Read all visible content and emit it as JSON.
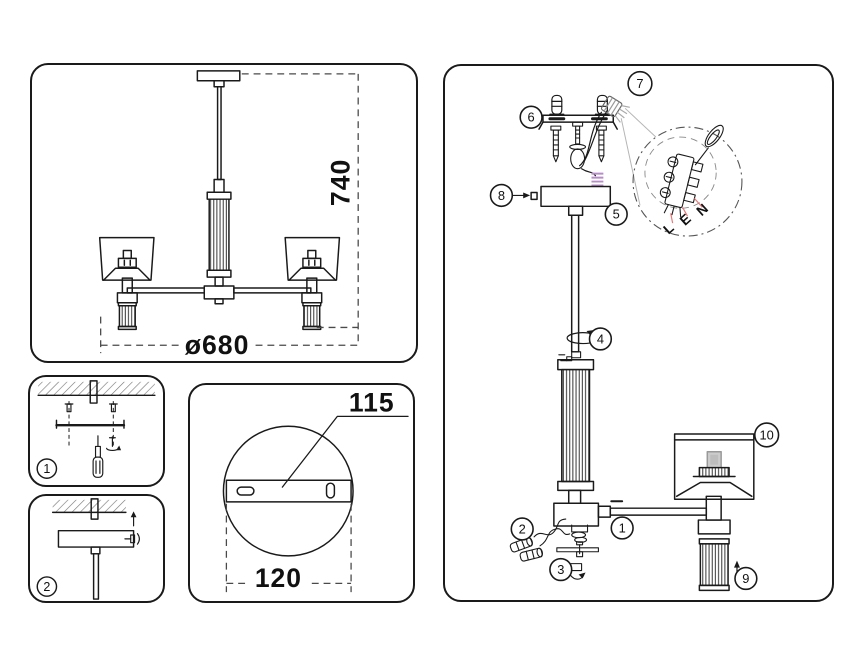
{
  "colors": {
    "line": "#1a1a1a",
    "accent_purple": "#b78cc8",
    "accent_red": "#e87a7a",
    "ghost": "#b5b5b5"
  },
  "overview_panel": {
    "height_dim": "740",
    "diameter_dim": "ø680"
  },
  "mounting_steps": {
    "step1_badge": "1",
    "step2_badge": "2"
  },
  "canopy_panel": {
    "bracket_dim": "115",
    "canopy_dim": "120"
  },
  "assembly_panel": {
    "badges": {
      "b1": "1",
      "b2": "2",
      "b3": "3",
      "b4": "4",
      "b5": "5",
      "b6": "6",
      "b7": "7",
      "b8": "8",
      "b9": "9",
      "b10": "10"
    },
    "terminal_labels": {
      "live": "L",
      "earth": "E",
      "neutral": "N"
    }
  }
}
